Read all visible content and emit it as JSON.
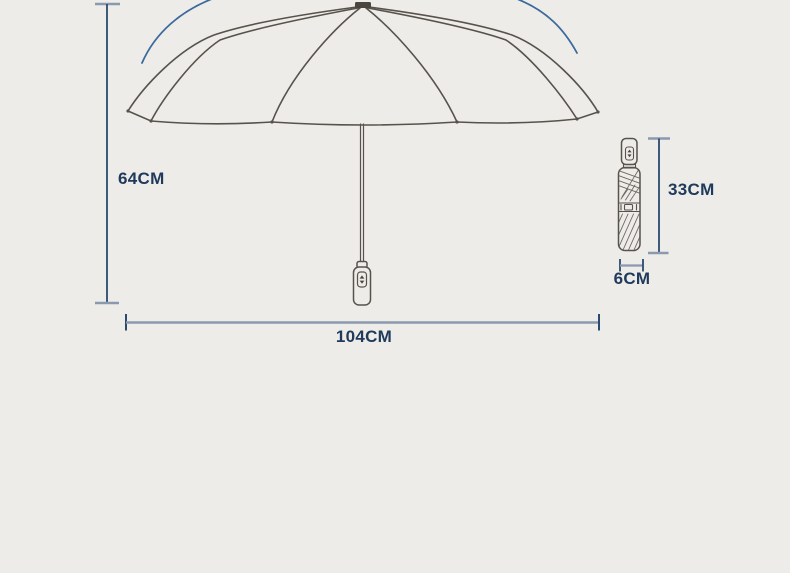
{
  "diagram": {
    "title": "umbrella-size-diagram",
    "open_umbrella": {
      "height_label": "64CM",
      "width_label": "104CM"
    },
    "folded_umbrella": {
      "height_label": "33CM",
      "width_label": "6CM"
    },
    "colors": {
      "background": "#eeece8",
      "label_navy": "#203a5c",
      "dimension_line_navy": "#2a4a6e",
      "dimension_cap_gray": "#8a99ad",
      "sketch_line": "#57524b",
      "motion_arc_blue": "#3c6a9c"
    }
  }
}
